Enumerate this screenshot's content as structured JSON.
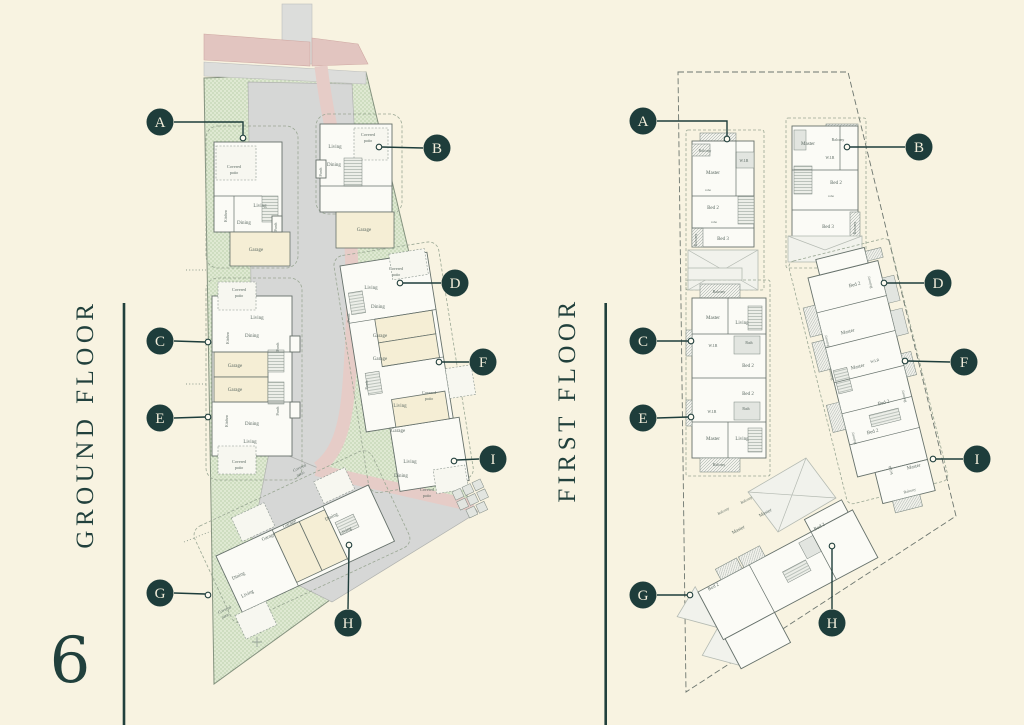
{
  "page": {
    "background": "#f8f3e1",
    "accent": "#1e3d3b",
    "page_number": "6"
  },
  "ground_floor": {
    "title": "GROUND FLOOR",
    "markers": [
      {
        "letter": "A",
        "cx": 160,
        "cy": 122,
        "leader": "174,122 243,122 243,135",
        "ex": 243,
        "ey": 138
      },
      {
        "letter": "B",
        "cx": 437,
        "cy": 148,
        "leader": "423,148 382,147",
        "ex": 379,
        "ey": 147
      },
      {
        "letter": "C",
        "cx": 160,
        "cy": 341,
        "leader": "174,341 205,342",
        "ex": 208,
        "ey": 342
      },
      {
        "letter": "D",
        "cx": 455,
        "cy": 283,
        "leader": "441,283 403,283",
        "ex": 400,
        "ey": 283
      },
      {
        "letter": "E",
        "cx": 160,
        "cy": 418,
        "leader": "174,418 205,417",
        "ex": 208,
        "ey": 417
      },
      {
        "letter": "F",
        "cx": 483,
        "cy": 362,
        "leader": "469,362 442,362",
        "ex": 439,
        "ey": 362
      },
      {
        "letter": "G",
        "cx": 160,
        "cy": 593,
        "leader": "174,593 205,594",
        "ex": 208,
        "ey": 595
      },
      {
        "letter": "H",
        "cx": 348,
        "cy": 623,
        "leader": "348,609 349,548",
        "ex": 349,
        "ey": 545
      },
      {
        "letter": "I",
        "cx": 493,
        "cy": 459,
        "leader": "479,459 457,460",
        "ex": 454,
        "ey": 461
      }
    ],
    "rooms": [
      {
        "t": "Covered",
        "x": 234,
        "y": 168,
        "s": 4.2
      },
      {
        "t": "patio",
        "x": 234,
        "y": 174,
        "s": 4.2
      },
      {
        "t": "Living",
        "x": 260,
        "y": 207
      },
      {
        "t": "Dining",
        "x": 244,
        "y": 224
      },
      {
        "t": "Kitchen",
        "x": 227,
        "y": 216,
        "r": -90,
        "s": 3.8
      },
      {
        "t": "Porch",
        "x": 277,
        "y": 227,
        "r": -90,
        "s": 3.8
      },
      {
        "t": "Garage",
        "x": 256,
        "y": 251
      },
      {
        "t": "Covered",
        "x": 368,
        "y": 136,
        "s": 4.2
      },
      {
        "t": "patio",
        "x": 368,
        "y": 142,
        "s": 4.2
      },
      {
        "t": "Living",
        "x": 335,
        "y": 148
      },
      {
        "t": "Dining",
        "x": 334,
        "y": 166
      },
      {
        "t": "Porch",
        "x": 322,
        "y": 172,
        "r": -90,
        "s": 3.8
      },
      {
        "t": "Garage",
        "x": 364,
        "y": 231
      },
      {
        "t": "Covered",
        "x": 239,
        "y": 291,
        "s": 4.2
      },
      {
        "t": "patio",
        "x": 239,
        "y": 297,
        "s": 4.2
      },
      {
        "t": "Living",
        "x": 257,
        "y": 319
      },
      {
        "t": "Dining",
        "x": 252,
        "y": 337
      },
      {
        "t": "Kitchen",
        "x": 229,
        "y": 338,
        "r": -90,
        "s": 3.8
      },
      {
        "t": "Porch",
        "x": 279,
        "y": 347,
        "r": -90,
        "s": 3.8
      },
      {
        "t": "Garage",
        "x": 235,
        "y": 367
      },
      {
        "t": "Garage",
        "x": 235,
        "y": 391
      },
      {
        "t": "Porch",
        "x": 279,
        "y": 411,
        "r": -90,
        "s": 3.8
      },
      {
        "t": "Dining",
        "x": 252,
        "y": 425
      },
      {
        "t": "Living",
        "x": 250,
        "y": 443
      },
      {
        "t": "Kitchen",
        "x": 228,
        "y": 421,
        "r": -90,
        "s": 3.8
      },
      {
        "t": "Covered",
        "x": 239,
        "y": 463,
        "s": 4.2
      },
      {
        "t": "patio",
        "x": 239,
        "y": 469,
        "s": 4.2
      },
      {
        "t": "Covered",
        "x": 396,
        "y": 270,
        "s": 4.2
      },
      {
        "t": "patio",
        "x": 396,
        "y": 276,
        "s": 4.2
      },
      {
        "t": "Living",
        "x": 371,
        "y": 289
      },
      {
        "t": "Dining",
        "x": 378,
        "y": 308
      },
      {
        "t": "Porch",
        "x": 350,
        "y": 318,
        "r": -90,
        "s": 3.8
      },
      {
        "t": "Garage",
        "x": 380,
        "y": 337
      },
      {
        "t": "Garage",
        "x": 380,
        "y": 360
      },
      {
        "t": "Porch",
        "x": 368,
        "y": 385,
        "r": -90,
        "s": 3.8
      },
      {
        "t": "Living",
        "x": 400,
        "y": 407
      },
      {
        "t": "Covered",
        "x": 429,
        "y": 394,
        "s": 4.2
      },
      {
        "t": "patio",
        "x": 429,
        "y": 400,
        "s": 4.2
      },
      {
        "t": "Garage",
        "x": 398,
        "y": 432
      },
      {
        "t": "Living",
        "x": 410,
        "y": 463
      },
      {
        "t": "Dining",
        "x": 401,
        "y": 477
      },
      {
        "t": "Covered",
        "x": 427,
        "y": 491,
        "s": 4.2
      },
      {
        "t": "patio",
        "x": 427,
        "y": 497,
        "s": 4.2
      },
      {
        "t": "Covered",
        "x": 300,
        "y": 469,
        "r": -25,
        "s": 4.2
      },
      {
        "t": "patio",
        "x": 301,
        "y": 475,
        "r": -25,
        "s": 4.2
      },
      {
        "t": "Dining",
        "x": 332,
        "y": 518,
        "r": -25
      },
      {
        "t": "Living",
        "x": 346,
        "y": 532,
        "r": -25
      },
      {
        "t": "Garage",
        "x": 290,
        "y": 525,
        "r": -25
      },
      {
        "t": "Garage",
        "x": 269,
        "y": 538,
        "r": -25
      },
      {
        "t": "Dining",
        "x": 239,
        "y": 577,
        "r": -25
      },
      {
        "t": "Living",
        "x": 248,
        "y": 595,
        "r": -25
      },
      {
        "t": "Covered",
        "x": 225,
        "y": 611,
        "r": -25,
        "s": 4.2
      },
      {
        "t": "patio",
        "x": 226,
        "y": 617,
        "r": -25,
        "s": 4.2
      }
    ]
  },
  "first_floor": {
    "title": "FIRST FLOOR",
    "markers": [
      {
        "letter": "A",
        "cx": 643,
        "cy": 121,
        "leader": "657,121 727,121 727,136",
        "ex": 727,
        "ey": 139
      },
      {
        "letter": "B",
        "cx": 919,
        "cy": 147,
        "leader": "905,147 850,147",
        "ex": 847,
        "ey": 147
      },
      {
        "letter": "C",
        "cx": 643,
        "cy": 341,
        "leader": "657,341 688,341",
        "ex": 691,
        "ey": 341
      },
      {
        "letter": "D",
        "cx": 938,
        "cy": 283,
        "leader": "924,283 887,283",
        "ex": 884,
        "ey": 283
      },
      {
        "letter": "E",
        "cx": 643,
        "cy": 418,
        "leader": "657,418 688,417",
        "ex": 691,
        "ey": 417
      },
      {
        "letter": "F",
        "cx": 964,
        "cy": 362,
        "leader": "950,362 908,361",
        "ex": 905,
        "ey": 361
      },
      {
        "letter": "G",
        "cx": 643,
        "cy": 595,
        "leader": "657,595 687,595",
        "ex": 690,
        "ey": 595
      },
      {
        "letter": "H",
        "cx": 832,
        "cy": 623,
        "leader": "832,609 832,549",
        "ex": 832,
        "ey": 546
      },
      {
        "letter": "I",
        "cx": 977,
        "cy": 459,
        "leader": "963,459 936,459",
        "ex": 933,
        "ey": 459
      }
    ],
    "rooms": [
      {
        "t": "Balcony",
        "x": 705,
        "y": 152,
        "s": 3.8
      },
      {
        "t": "Master",
        "x": 713,
        "y": 174
      },
      {
        "t": "W.I.R",
        "x": 744,
        "y": 162,
        "s": 3.8
      },
      {
        "t": "robe",
        "x": 708,
        "y": 191,
        "s": 3.4
      },
      {
        "t": "Bed 2",
        "x": 713,
        "y": 209
      },
      {
        "t": "robe",
        "x": 714,
        "y": 223,
        "s": 3.4
      },
      {
        "t": "Bed 3",
        "x": 723,
        "y": 240
      },
      {
        "t": "Balcony",
        "x": 697,
        "y": 240,
        "r": -90,
        "s": 3.8
      },
      {
        "t": "Master",
        "x": 808,
        "y": 145
      },
      {
        "t": "Balcony",
        "x": 838,
        "y": 141,
        "s": 3.8
      },
      {
        "t": "W.I.R",
        "x": 830,
        "y": 159,
        "s": 3.8
      },
      {
        "t": "Bed 2",
        "x": 836,
        "y": 184
      },
      {
        "t": "robe",
        "x": 831,
        "y": 197,
        "s": 3.4
      },
      {
        "t": "Bed 3",
        "x": 828,
        "y": 228
      },
      {
        "t": "Balcony",
        "x": 856,
        "y": 228,
        "r": -90,
        "s": 3.8
      },
      {
        "t": "Balcony",
        "x": 719,
        "y": 293,
        "s": 3.8
      },
      {
        "t": "Master",
        "x": 713,
        "y": 319
      },
      {
        "t": "Living",
        "x": 742,
        "y": 324
      },
      {
        "t": "W.I.R",
        "x": 713,
        "y": 347,
        "s": 3.8
      },
      {
        "t": "Bath",
        "x": 749,
        "y": 344,
        "s": 3.8
      },
      {
        "t": "Bed 2",
        "x": 748,
        "y": 367
      },
      {
        "t": "Bed 2",
        "x": 748,
        "y": 395
      },
      {
        "t": "W.I.R",
        "x": 712,
        "y": 413,
        "s": 3.8
      },
      {
        "t": "Bath",
        "x": 746,
        "y": 410,
        "s": 3.8
      },
      {
        "t": "Master",
        "x": 713,
        "y": 440
      },
      {
        "t": "Living",
        "x": 742,
        "y": 440
      },
      {
        "t": "Balcony",
        "x": 719,
        "y": 466,
        "s": 3.8
      },
      {
        "t": "Bed 2",
        "x": 855,
        "y": 286,
        "r": -14
      },
      {
        "t": "Balcony",
        "x": 871,
        "y": 282,
        "r": -104,
        "s": 3.8
      },
      {
        "t": "Master",
        "x": 848,
        "y": 333,
        "r": -14
      },
      {
        "t": "Balcony",
        "x": 828,
        "y": 341,
        "r": -104,
        "s": 3.8
      },
      {
        "t": "W.I.R",
        "x": 875,
        "y": 362,
        "r": -14,
        "s": 3.8
      },
      {
        "t": "Master",
        "x": 858,
        "y": 368,
        "r": -14
      },
      {
        "t": "Balcony",
        "x": 832,
        "y": 374,
        "r": -104,
        "s": 3.8
      },
      {
        "t": "Bed 2",
        "x": 884,
        "y": 404,
        "r": -14
      },
      {
        "t": "Balcony",
        "x": 905,
        "y": 396,
        "r": -104,
        "s": 3.8
      },
      {
        "t": "Bed 2",
        "x": 873,
        "y": 433,
        "r": -14
      },
      {
        "t": "Balcony",
        "x": 855,
        "y": 438,
        "r": -104,
        "s": 3.8
      },
      {
        "t": "Master",
        "x": 914,
        "y": 468,
        "r": -14
      },
      {
        "t": "W.I.R",
        "x": 892,
        "y": 470,
        "r": -104,
        "s": 3.8
      },
      {
        "t": "Balcony",
        "x": 910,
        "y": 492,
        "r": -14,
        "s": 3.8
      },
      {
        "t": "Balcony",
        "x": 724,
        "y": 512,
        "r": -28,
        "s": 3.8
      },
      {
        "t": "Balcony",
        "x": 747,
        "y": 501,
        "r": -28,
        "s": 3.8
      },
      {
        "t": "Master",
        "x": 766,
        "y": 514,
        "r": -28
      },
      {
        "t": "Master",
        "x": 739,
        "y": 531,
        "r": -28
      },
      {
        "t": "Bed 2",
        "x": 820,
        "y": 528,
        "r": -28
      },
      {
        "t": "Bed 2",
        "x": 714,
        "y": 588,
        "r": -28
      }
    ]
  }
}
